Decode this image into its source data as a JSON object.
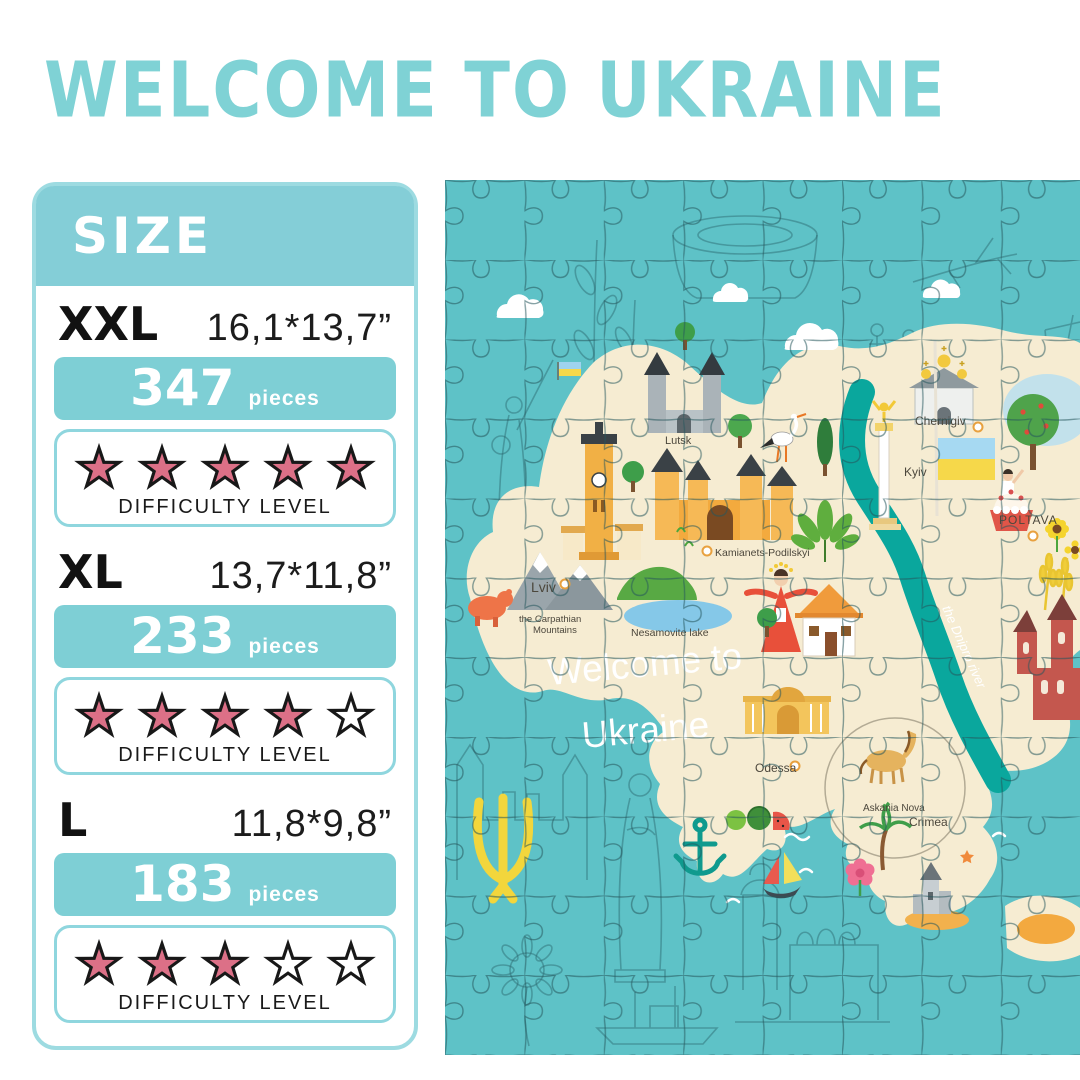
{
  "title": "WELCOME TO UKRAINE",
  "colors": {
    "accent_teal": "#7fd2d5",
    "header_teal": "#84ced7",
    "bar_teal": "#7ecfd5",
    "panel_border_teal": "#9ddbe1",
    "difficulty_border_teal": "#8fd6de",
    "star_pink": "#dc7087",
    "star_black": "#181818",
    "sea_teal": "#5ec2c7",
    "map_cream": "#f6ecd2",
    "river_teal": "#0aa79d",
    "trident_yellow": "#f2d63c"
  },
  "size_panel": {
    "header": "SIZE",
    "pieces_word": "pieces",
    "difficulty_caption": "DIFFICULTY LEVEL",
    "max_stars": 5,
    "sizes": [
      {
        "label": "XXL",
        "dimensions": "16,1*13,7”",
        "pieces": "347",
        "difficulty": 5
      },
      {
        "label": "XL",
        "dimensions": "13,7*11,8”",
        "pieces": "233",
        "difficulty": 4
      },
      {
        "label": "L",
        "dimensions": "11,8*9,8”",
        "pieces": "183",
        "difficulty": 3
      }
    ]
  },
  "puzzle": {
    "welcome_line1": "Welcome to",
    "welcome_line2": "Ukraine",
    "river_label": "the Dnipro river",
    "labels": {
      "lviv": "Lviv",
      "lutsk": "Lutsk",
      "kamianets": "Kamianets-Podilskyi",
      "carpathian_1": "the Carpathian",
      "carpathian_2": "Mountains",
      "nesamovite": "Nesamovite lake",
      "chernihiv": "Chernigiv",
      "kyiv": "Kyiv",
      "poltava": "POLTAVA",
      "odessa": "Odessa",
      "askania": "Askania Nova",
      "crimea": "Crimea"
    }
  }
}
